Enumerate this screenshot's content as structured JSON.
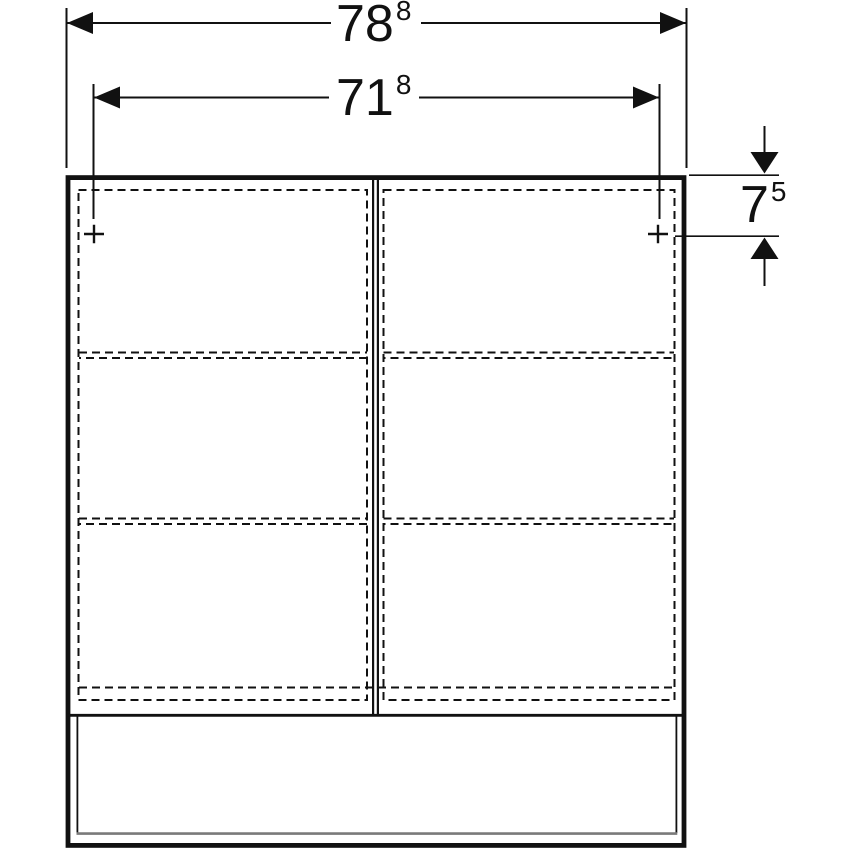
{
  "dimensions": {
    "outer_width": {
      "value": "78",
      "sup": "8"
    },
    "inner_width": {
      "value": "71",
      "sup": "8"
    },
    "top_offset": {
      "value": "7",
      "sup": "5"
    }
  },
  "colors": {
    "line": "#111111",
    "muted_line": "#7a7a7a",
    "background": "#ffffff"
  }
}
